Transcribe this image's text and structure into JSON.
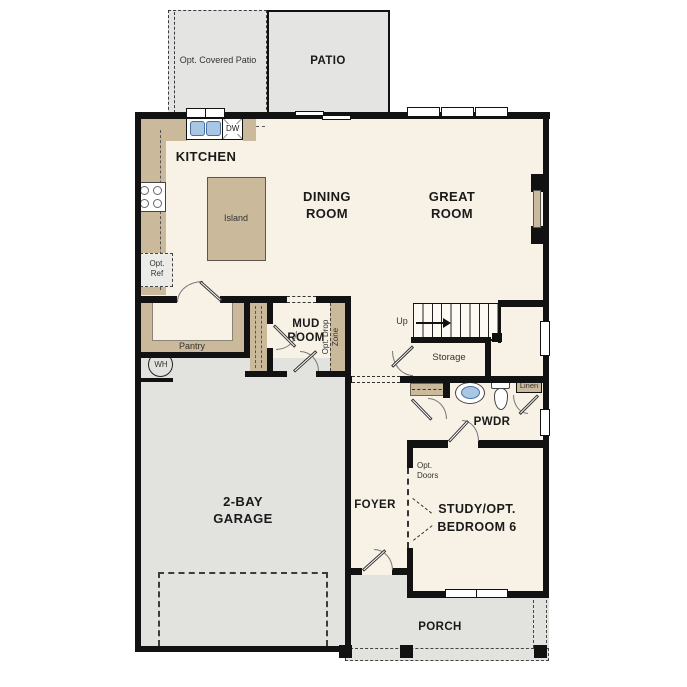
{
  "plan_title": "First floor residential floor plan",
  "labels": {
    "opt_covered_patio": "Opt. Covered Patio",
    "patio": "PATIO",
    "kitchen": "KITCHEN",
    "dw": "DW",
    "island": "Island",
    "dining_1": "DINING",
    "dining_2": "ROOM",
    "great_1": "GREAT",
    "great_2": "ROOM",
    "opt_ref_1": "Opt.",
    "opt_ref_2": "Ref",
    "pantry": "Pantry",
    "mud_1": "MUD",
    "mud_2": "ROOM",
    "drop_zone_1": "Opt. Drop",
    "drop_zone_2": "Zone",
    "up": "Up",
    "storage": "Storage",
    "wh": "WH",
    "linen": "Linen",
    "pwdr": "PWDR",
    "garage_1": "2-BAY",
    "garage_2": "GARAGE",
    "foyer": "FOYER",
    "opt_doors_1": "Opt.",
    "opt_doors_2": "Doors",
    "study_1": "STUDY/OPT.",
    "study_2": "BEDROOM 6",
    "porch": "PORCH"
  },
  "colors": {
    "wall": "#121212",
    "floor": "#f8f1e5",
    "patio_gray": "#e4e4e2",
    "garage_gray": "#e2e2df",
    "cabinet_tan": "#cab99a",
    "fixture_blue": "#a9c7e5",
    "optional_fill": "#ebebe8"
  }
}
